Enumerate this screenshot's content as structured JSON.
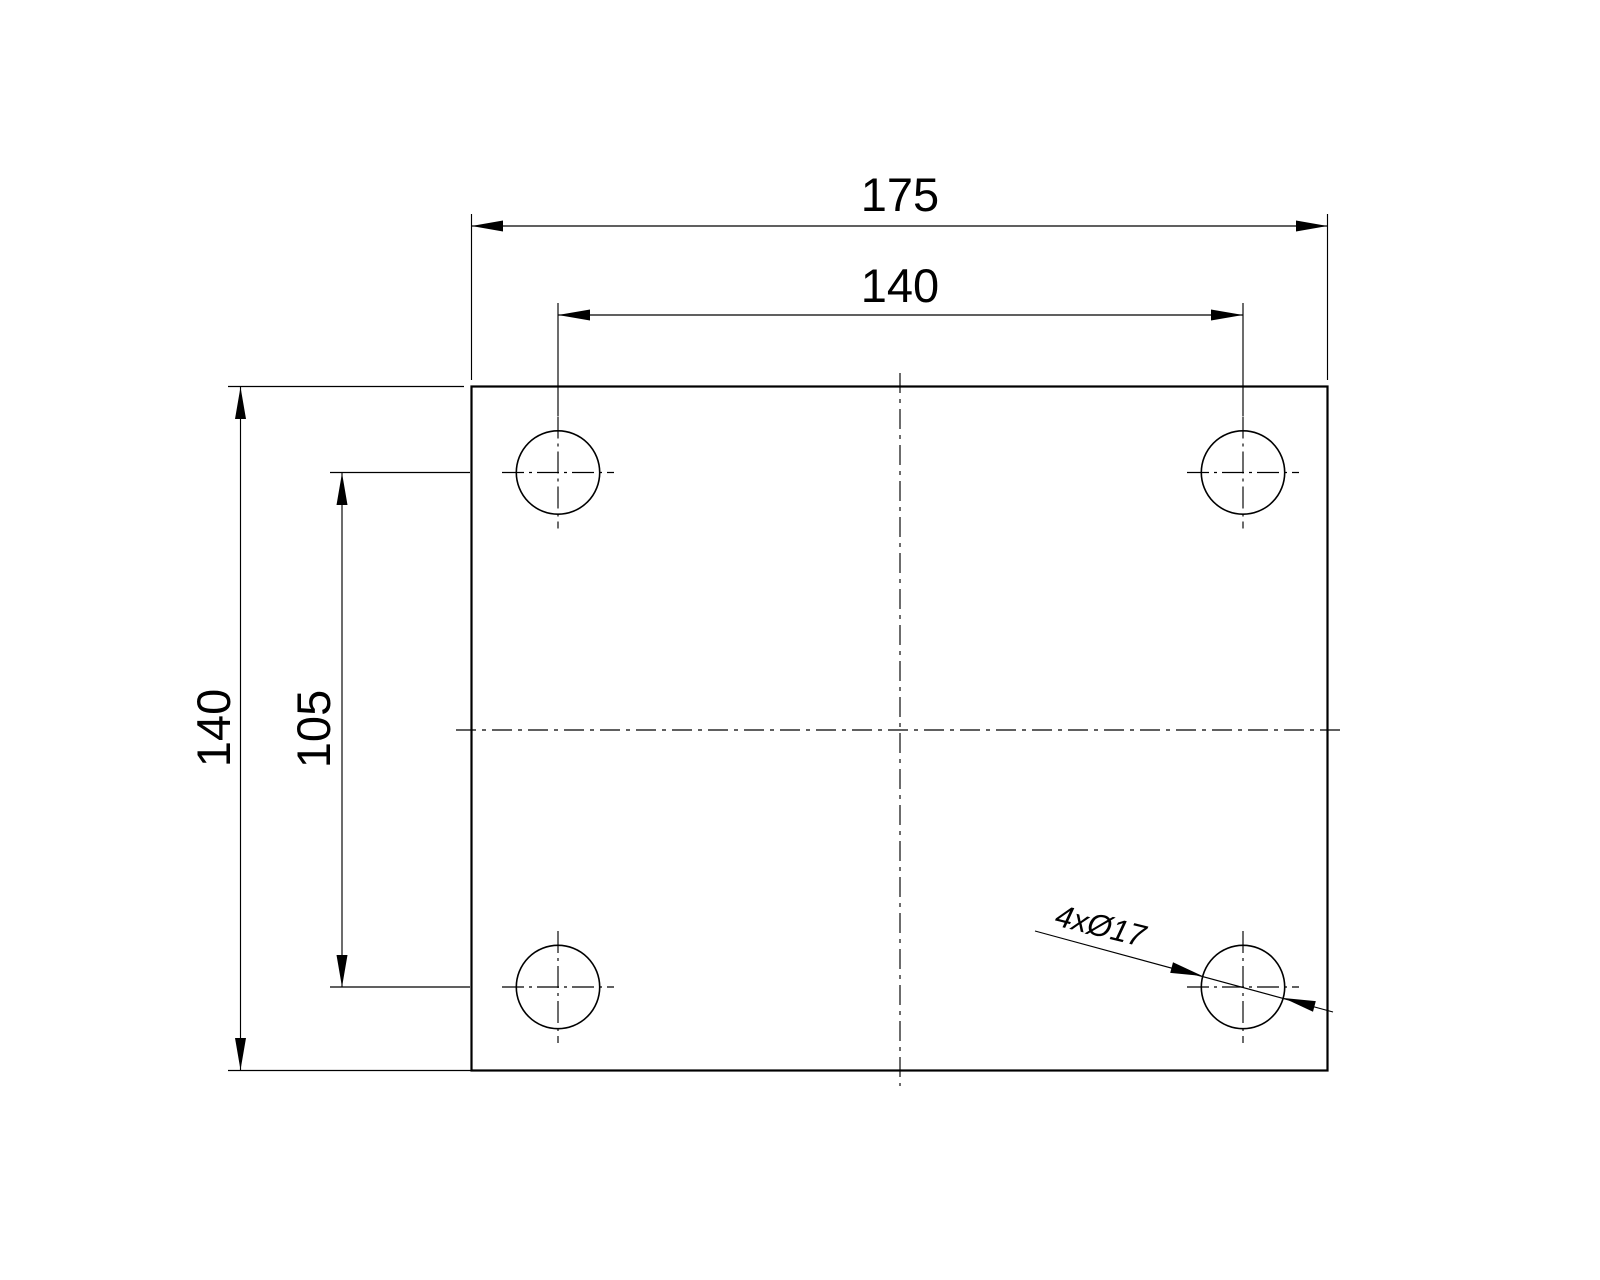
{
  "drawing": {
    "title": "plate-drilling-drawing",
    "background_color": "#ffffff",
    "ink_color": "#000000",
    "labels": {
      "overall_width": "175",
      "bolt_spacing_horizontal": "140",
      "overall_height": "140",
      "bolt_spacing_vertical": "105",
      "hole_callout": "4xØ17"
    },
    "values": {
      "overall_width_mm": 175,
      "overall_height_mm": 140,
      "bolt_spacing_horizontal_mm": 140,
      "bolt_spacing_vertical_mm": 105,
      "hole_count": 4,
      "hole_diameter_mm": 17
    }
  }
}
